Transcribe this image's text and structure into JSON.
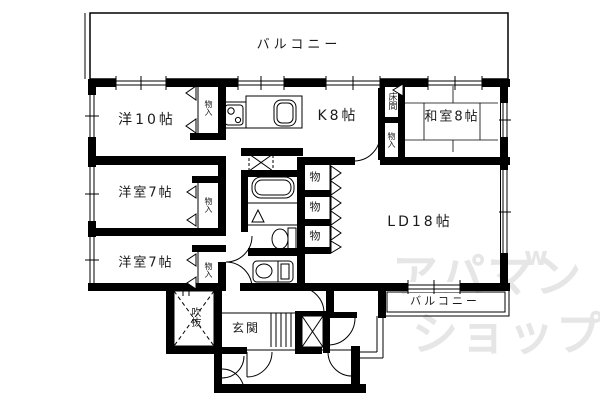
{
  "labels": {
    "balcony": "バルコニー",
    "west10": "洋10帖",
    "kitchen": "K8帖",
    "japanese_room": "和室8帖",
    "west7": "洋室7帖",
    "living_dining": "LD18帖",
    "genkan": "玄関",
    "fukinuke": "吹抜",
    "tokonoma": "床間",
    "closet": "物入",
    "storage": "物"
  },
  "watermark": {
    "line1": "アパマン",
    "line2": "ショップ",
    "mark": "w",
    "color": "#e6e6e6"
  },
  "colors": {
    "line": "#000000",
    "background": "#ffffff"
  }
}
